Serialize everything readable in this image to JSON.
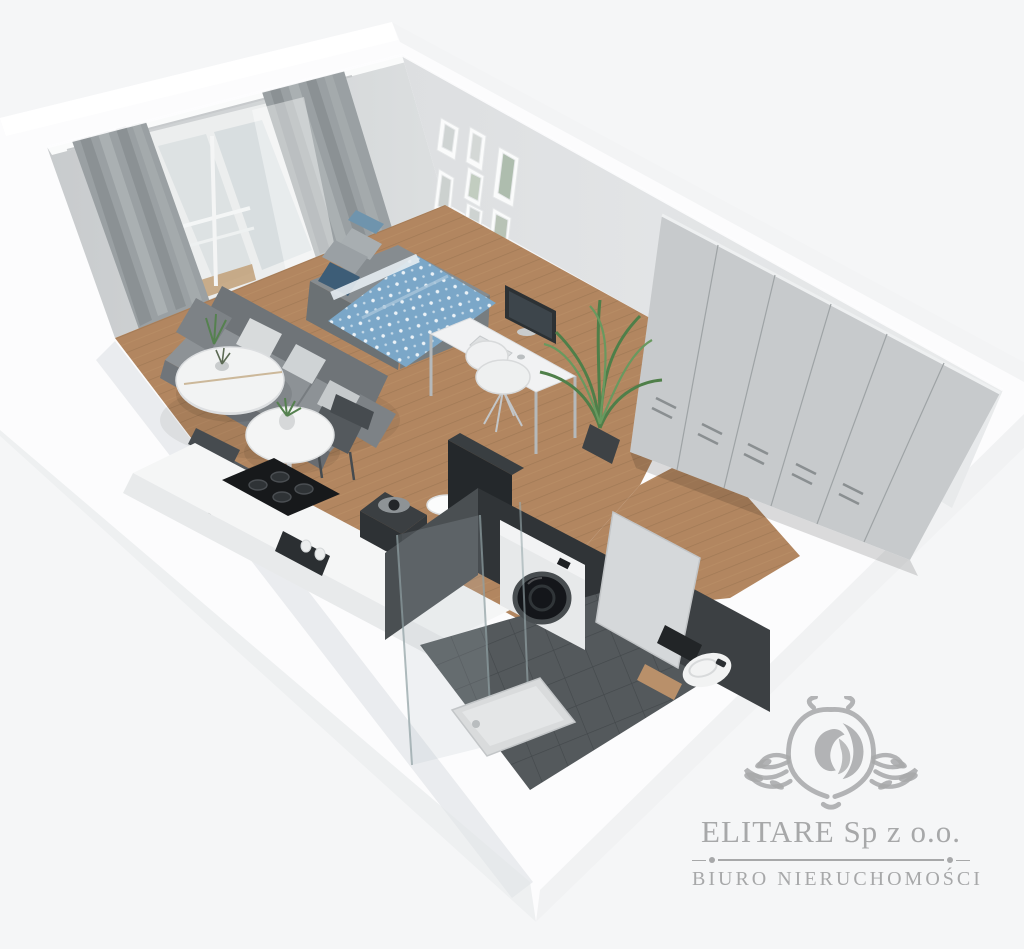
{
  "watermark": {
    "company": "ELITARE Sp z o.o.",
    "tagline": "BIURO NIERUCHOMOŚCI",
    "crest_icon": "lion-crest-icon"
  },
  "scene": {
    "type": "3d-apartment-floorplan-render",
    "rooms": [
      "living-sleeping-area",
      "kitchenette",
      "bathroom",
      "balcony",
      "hallway"
    ],
    "objects": [
      "gray-curtains",
      "sheer-curtain",
      "balcony-door",
      "gray-sofa",
      "throw-pillows",
      "round-coffee-table",
      "round-dining-table",
      "dark-chairs",
      "single-bed-blue-bedding",
      "gallery-picture-frames",
      "white-desk",
      "monitor",
      "white-shell-chair",
      "palm-plant",
      "large-gray-wardrobe",
      "white-kitchen-counter",
      "black-cooktop",
      "coffee-machine",
      "sink-gold-faucet",
      "tall-dark-cabinet",
      "washing-machine",
      "glass-shower",
      "shower-tray",
      "dark-wall-tiles",
      "bathroom-door",
      "toilet",
      "wood-shelf"
    ]
  },
  "colors": {
    "bg": "#f5f6f7",
    "wm": "#a3a4a5",
    "wood": "#b28660",
    "duvet": "#7ba7c8",
    "tile": "#54595c",
    "wardrobe": "#c7cacc",
    "wallL": "#d4d7d9",
    "wallR": "#e2e4e6"
  }
}
